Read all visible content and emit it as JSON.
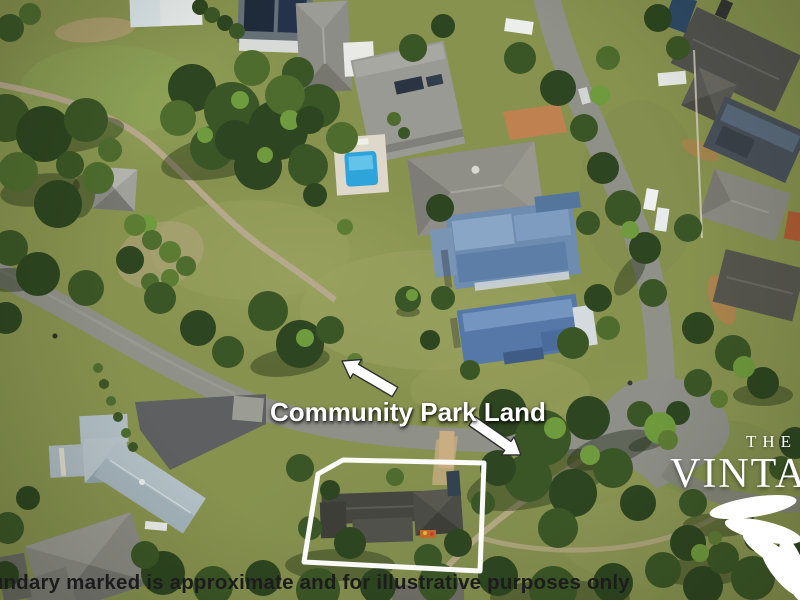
{
  "annotations": {
    "park_label": {
      "text": "Community Park Land",
      "color": "#ffffff"
    },
    "arrows": [
      {
        "icon": "arrow-up-left-icon",
        "direction": "up-left",
        "fill": "#ffffff",
        "outline": "#2f2f2f"
      },
      {
        "icon": "arrow-down-right-icon",
        "direction": "down-right",
        "fill": "#ffffff",
        "outline": "#2f2f2f"
      }
    ],
    "property_boundary": {
      "shape": "polygon",
      "color": "#ffffff"
    },
    "disclaimer": {
      "text": "Boundary marked is approximate and for illustrative purposes only",
      "visible_text": "ndary marked is approximate and for illustrative purposes only",
      "color": "#1c1c1c"
    },
    "brand_logo": {
      "line1": "THE",
      "line2": "VINTAGE",
      "visible_line2": "VINTA",
      "color": "#ffffff",
      "icon": "vine-fan-icon"
    }
  },
  "scene": {
    "type": "aerial-photograph",
    "palette": {
      "grass": "#87924f",
      "road": "#8f9088",
      "walking_path": "#b6a88c",
      "tree_dark": "#2d4520",
      "tree_bright": "#6f9a3d",
      "roof_gray": "#8d8d88",
      "roof_dark": "#474640",
      "roof_blue": "#5578a8",
      "roof_pale_blue": "#b2bfc6",
      "pool": "#2ea4da",
      "dirt_orange": "#c28150"
    }
  }
}
